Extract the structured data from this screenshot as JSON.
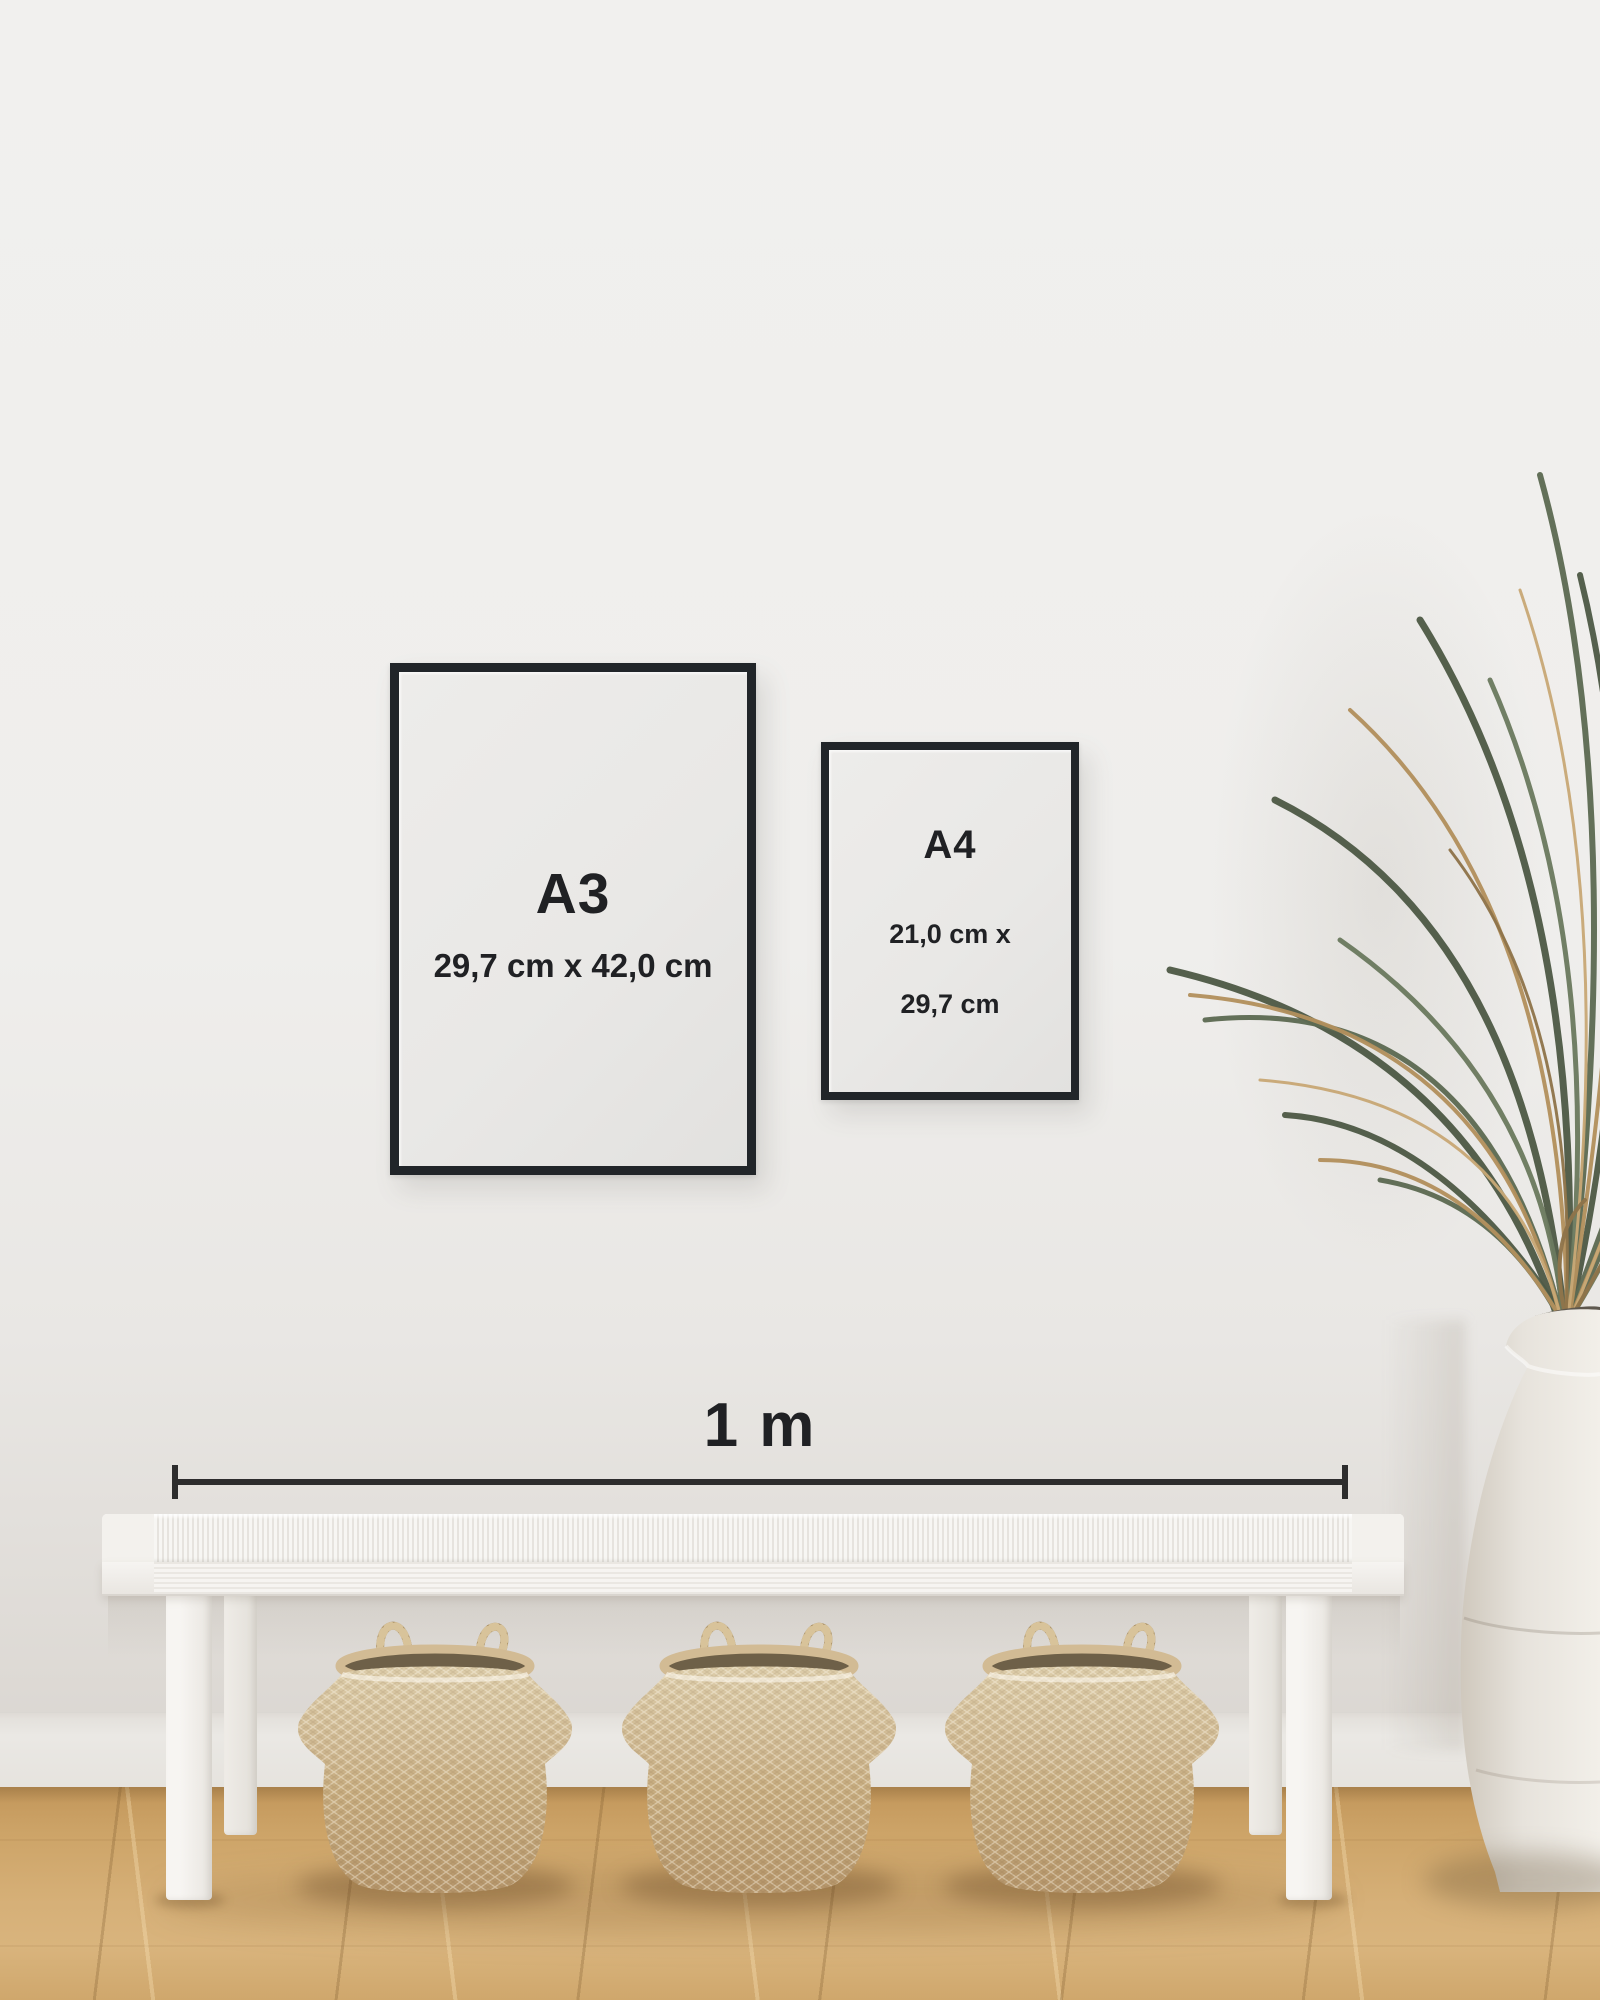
{
  "frames": [
    {
      "label": "A3",
      "dimensions": "29,7 cm x 42,0 cm"
    },
    {
      "label": "A4",
      "dimensions_line1": "21,0 cm x",
      "dimensions_line2": "29,7 cm"
    }
  ],
  "scale_bar": {
    "label": "1 m"
  },
  "colors": {
    "frame_border": "#212529",
    "text": "#202124",
    "wall": "#f0efed",
    "paper": "#e9e8e6",
    "scale": "#2d2d2d",
    "floor": "#cda468",
    "bench": "#f3f1ed",
    "basket": "#c9b189",
    "basket_dark": "#b3946a",
    "plant_green": "#5d6a52",
    "plant_dry": "#b2905d",
    "vase": "#ece8e2",
    "skirting": "#eae8e4",
    "wall_lower": "#dcd8d3"
  }
}
